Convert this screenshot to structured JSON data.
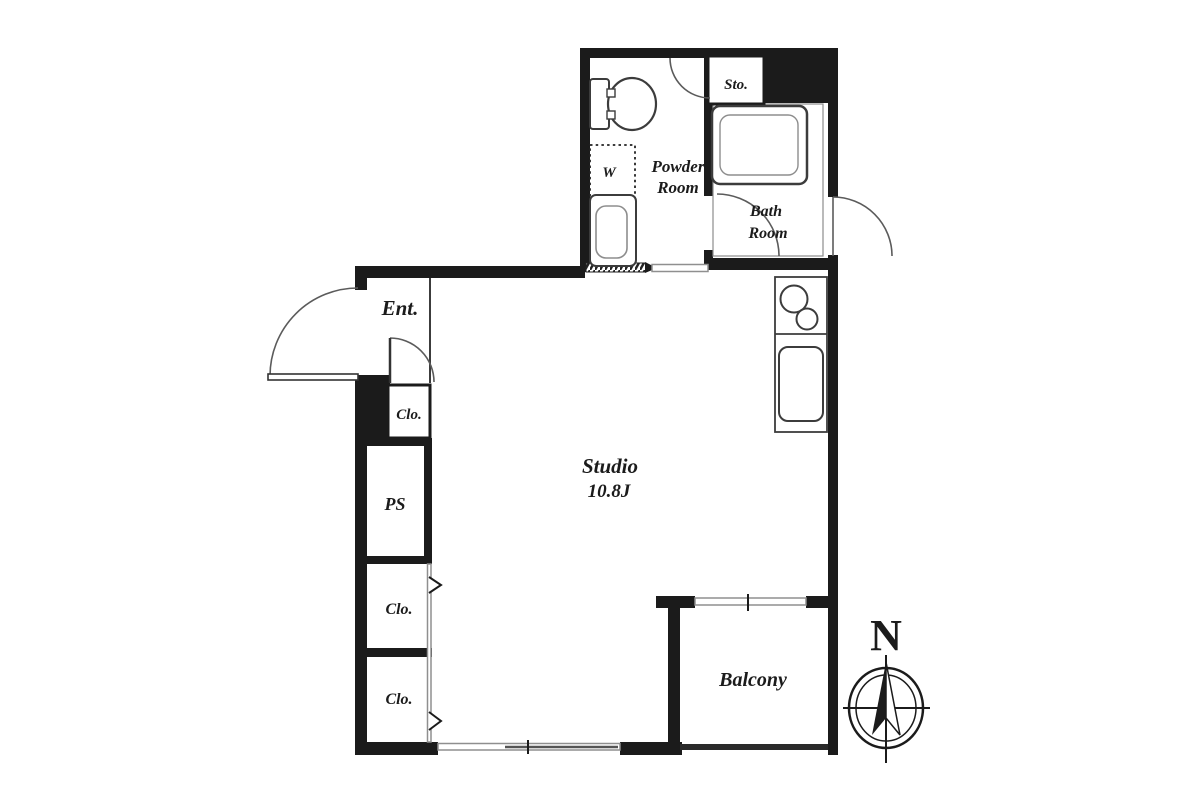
{
  "figure_type": "apartment-floor-plan",
  "plan_labels": {
    "entrance": "Ent.",
    "entrance_closet": "Clo.",
    "pipe_space": "PS",
    "closet_middle": "Clo.",
    "closet_lower": "Clo.",
    "studio_name": "Studio",
    "studio_size": "10.8J",
    "powder_room_line1": "Powder",
    "powder_room_line2": "Room",
    "bath_room_line1": "Bath",
    "bath_room_line2": "Room",
    "storage": "Sto.",
    "washing_machine": "W",
    "balcony": "Balcony"
  },
  "compass": {
    "north_label": "N"
  },
  "colors": {
    "wall": "#1b1b1b",
    "ink": "#1b1b1b",
    "thin_line": "#3c3c3c",
    "window_line": "#8f8f8f",
    "background": "#ffffff"
  }
}
